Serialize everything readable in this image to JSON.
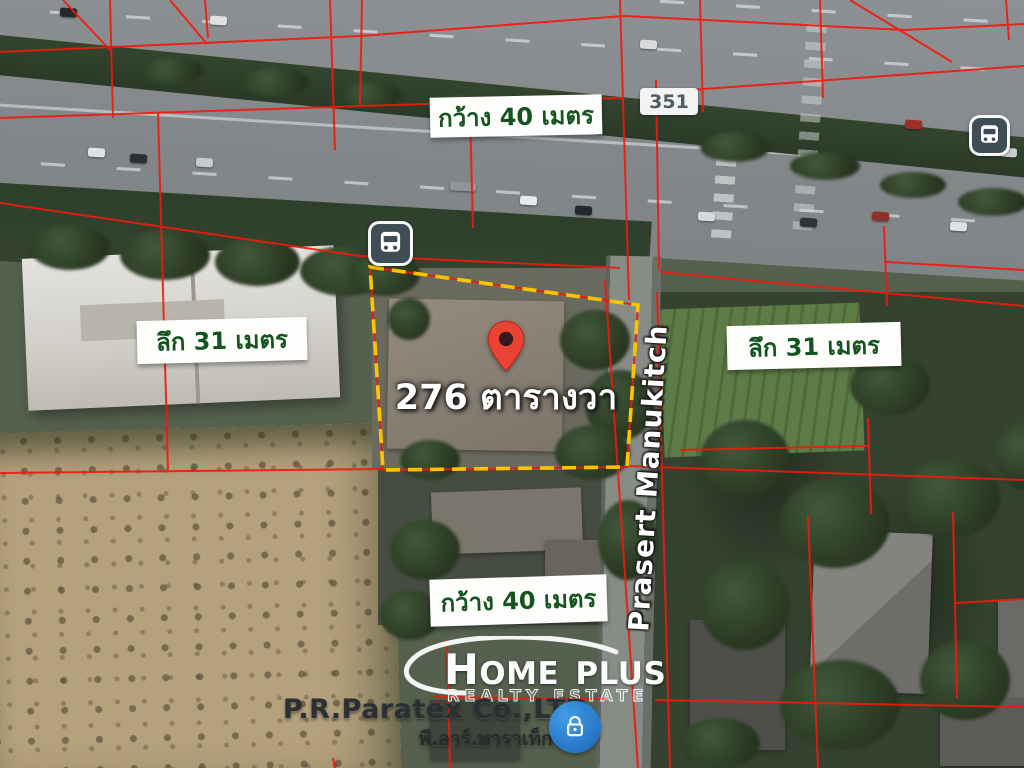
{
  "map": {
    "area_label": "276 ตารางวา",
    "width_label_top": "กว้าง 40 เมตร",
    "width_label_bottom": "กว้าง 40 เมตร",
    "depth_label_left": "ลึก 31 เมตร",
    "depth_label_right": "ลึก 31 เมตร",
    "route_badge": "351",
    "road_name": "Prasert Manukitch"
  },
  "watermark": {
    "logo_line1": "HOME PLUS",
    "logo_line2": "REALTY ESTATE",
    "company": "P.R.Paratex Co.,LTD",
    "company_thai": "พี.อาร์.พาราเท็กซ์"
  },
  "colors": {
    "parcel_line": "#f3180c",
    "property_outline": "#ffc400",
    "label_text_green": "#14541f",
    "pin_red": "#ea4335",
    "lock_badge_blue": "#1e88e5",
    "bus_icon_bg": "#3f4d55"
  },
  "icons": {
    "bus": "bus-stop-icon",
    "pin": "location-pin-icon",
    "lock": "lock-icon"
  }
}
